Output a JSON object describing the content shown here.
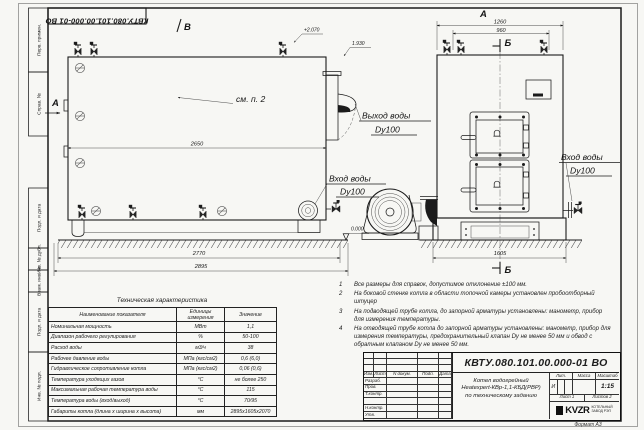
{
  "sheet": {
    "doc_number": "КВТУ.080.101.00.000-01 ВО",
    "format_label": "Формат А3"
  },
  "margin": {
    "labels": [
      "Перв. примен.",
      "Справ. №",
      "Подп. и дата",
      "Инв. № дубл.",
      "Взам. инв. №",
      "Подп. и дата",
      "Инв. № подл."
    ]
  },
  "drawing": {
    "views": {
      "top_b": "В",
      "left_a": "А",
      "front_a": "А",
      "section_b_top": "Б",
      "section_b_bottom": "Б"
    },
    "note_ref": "см. п. 2",
    "elevations": {
      "plus2070": "+2.070",
      "l1930": "1.930",
      "zero": "0.000"
    },
    "dims": {
      "d2650": "2650",
      "d2770": "2770",
      "d2895": "2895",
      "d1260": "1260",
      "d960": "960",
      "d1605": "1605"
    },
    "callouts": {
      "outlet_l1": "Выход воды",
      "outlet_l2": "Dy100",
      "inlet_front_l1": "Вход воды",
      "inlet_front_l2": "Dy100",
      "inlet_side_l1": "Вход воды",
      "inlet_side_l2": "Dy100"
    }
  },
  "notes": {
    "items": [
      {
        "num": "1",
        "text": "Все размеры для справок, допустимое отклонение ±100 мм."
      },
      {
        "num": "2",
        "text": "На боковой стенке котла в области топочной камеры установлен пробоотборный штуцер"
      },
      {
        "num": "3",
        "text": "На подводящей трубе котла, до запорной арматуры установлены: манометр, прибор для измерения температуры."
      },
      {
        "num": "4",
        "text": "На отводящей трубе котла до запорной арматуры установлены: манометр, прибор для измерения температуры, предохранительный клапан Dy не менее 50 мм и обвод с обратным клапаном Dy не менее 50 мм."
      }
    ]
  },
  "spec": {
    "title": "Техническая характеристика",
    "headers": {
      "name": "Наименование показателя",
      "units": "Единицы измерения",
      "value": "Значение"
    },
    "rows": [
      {
        "name": "Номинальная мощность",
        "units": "МВт",
        "value": "1,1"
      },
      {
        "name": "Диапазон рабочего регулирования",
        "units": "%",
        "value": "50-100"
      },
      {
        "name": "Расход воды",
        "units": "м3/ч",
        "value": "38"
      },
      {
        "name": "Рабочее давление воды",
        "units": "МПа (кгс/см2)",
        "value": "0,6 (6,0)"
      },
      {
        "name": "Гидравлическое сопротивление котла",
        "units": "МПа (кгс/см2)",
        "value": "0,06 (0,6)"
      },
      {
        "name": "Температура уходящих газов",
        "units": "°С",
        "value": "не более 250"
      },
      {
        "name": "Максимальная рабочая температура воды",
        "units": "°С",
        "value": "115"
      },
      {
        "name": "Температура воды (вход/выход)",
        "units": "°С",
        "value": "70/95"
      },
      {
        "name": "Габариты котла (длина х ширина х высота)",
        "units": "мм",
        "value": "2895х1605х2070"
      }
    ]
  },
  "stamp": {
    "rev_cols": {
      "izm": "Изм.",
      "list": "Лист",
      "doc": "N докум.",
      "sign": "Подп.",
      "date": "Дата"
    },
    "roles": {
      "r1": "Разраб.",
      "r2": "Пров.",
      "r3": "Т.контр.",
      "r4": "Н.контр.",
      "r5": "Утв."
    },
    "title_l1": "Котел водогрейный",
    "title_l2": "Heatexpert-КВр-1,1-КБД(РВР)",
    "title_l3": "по техническому заданию",
    "lit": {
      "header_lit": "Лит.",
      "header_mass": "Масса",
      "header_scale": "Масштаб",
      "lit_value": "И",
      "scale_value": "1:15"
    },
    "sheets": {
      "list_label": "Лист 1",
      "total_label": "Листов 2"
    },
    "company": {
      "logo": "KVZR",
      "line1": "КОТЕЛЬНЫЙ",
      "line2": "ЗАВОД РЭП"
    }
  }
}
